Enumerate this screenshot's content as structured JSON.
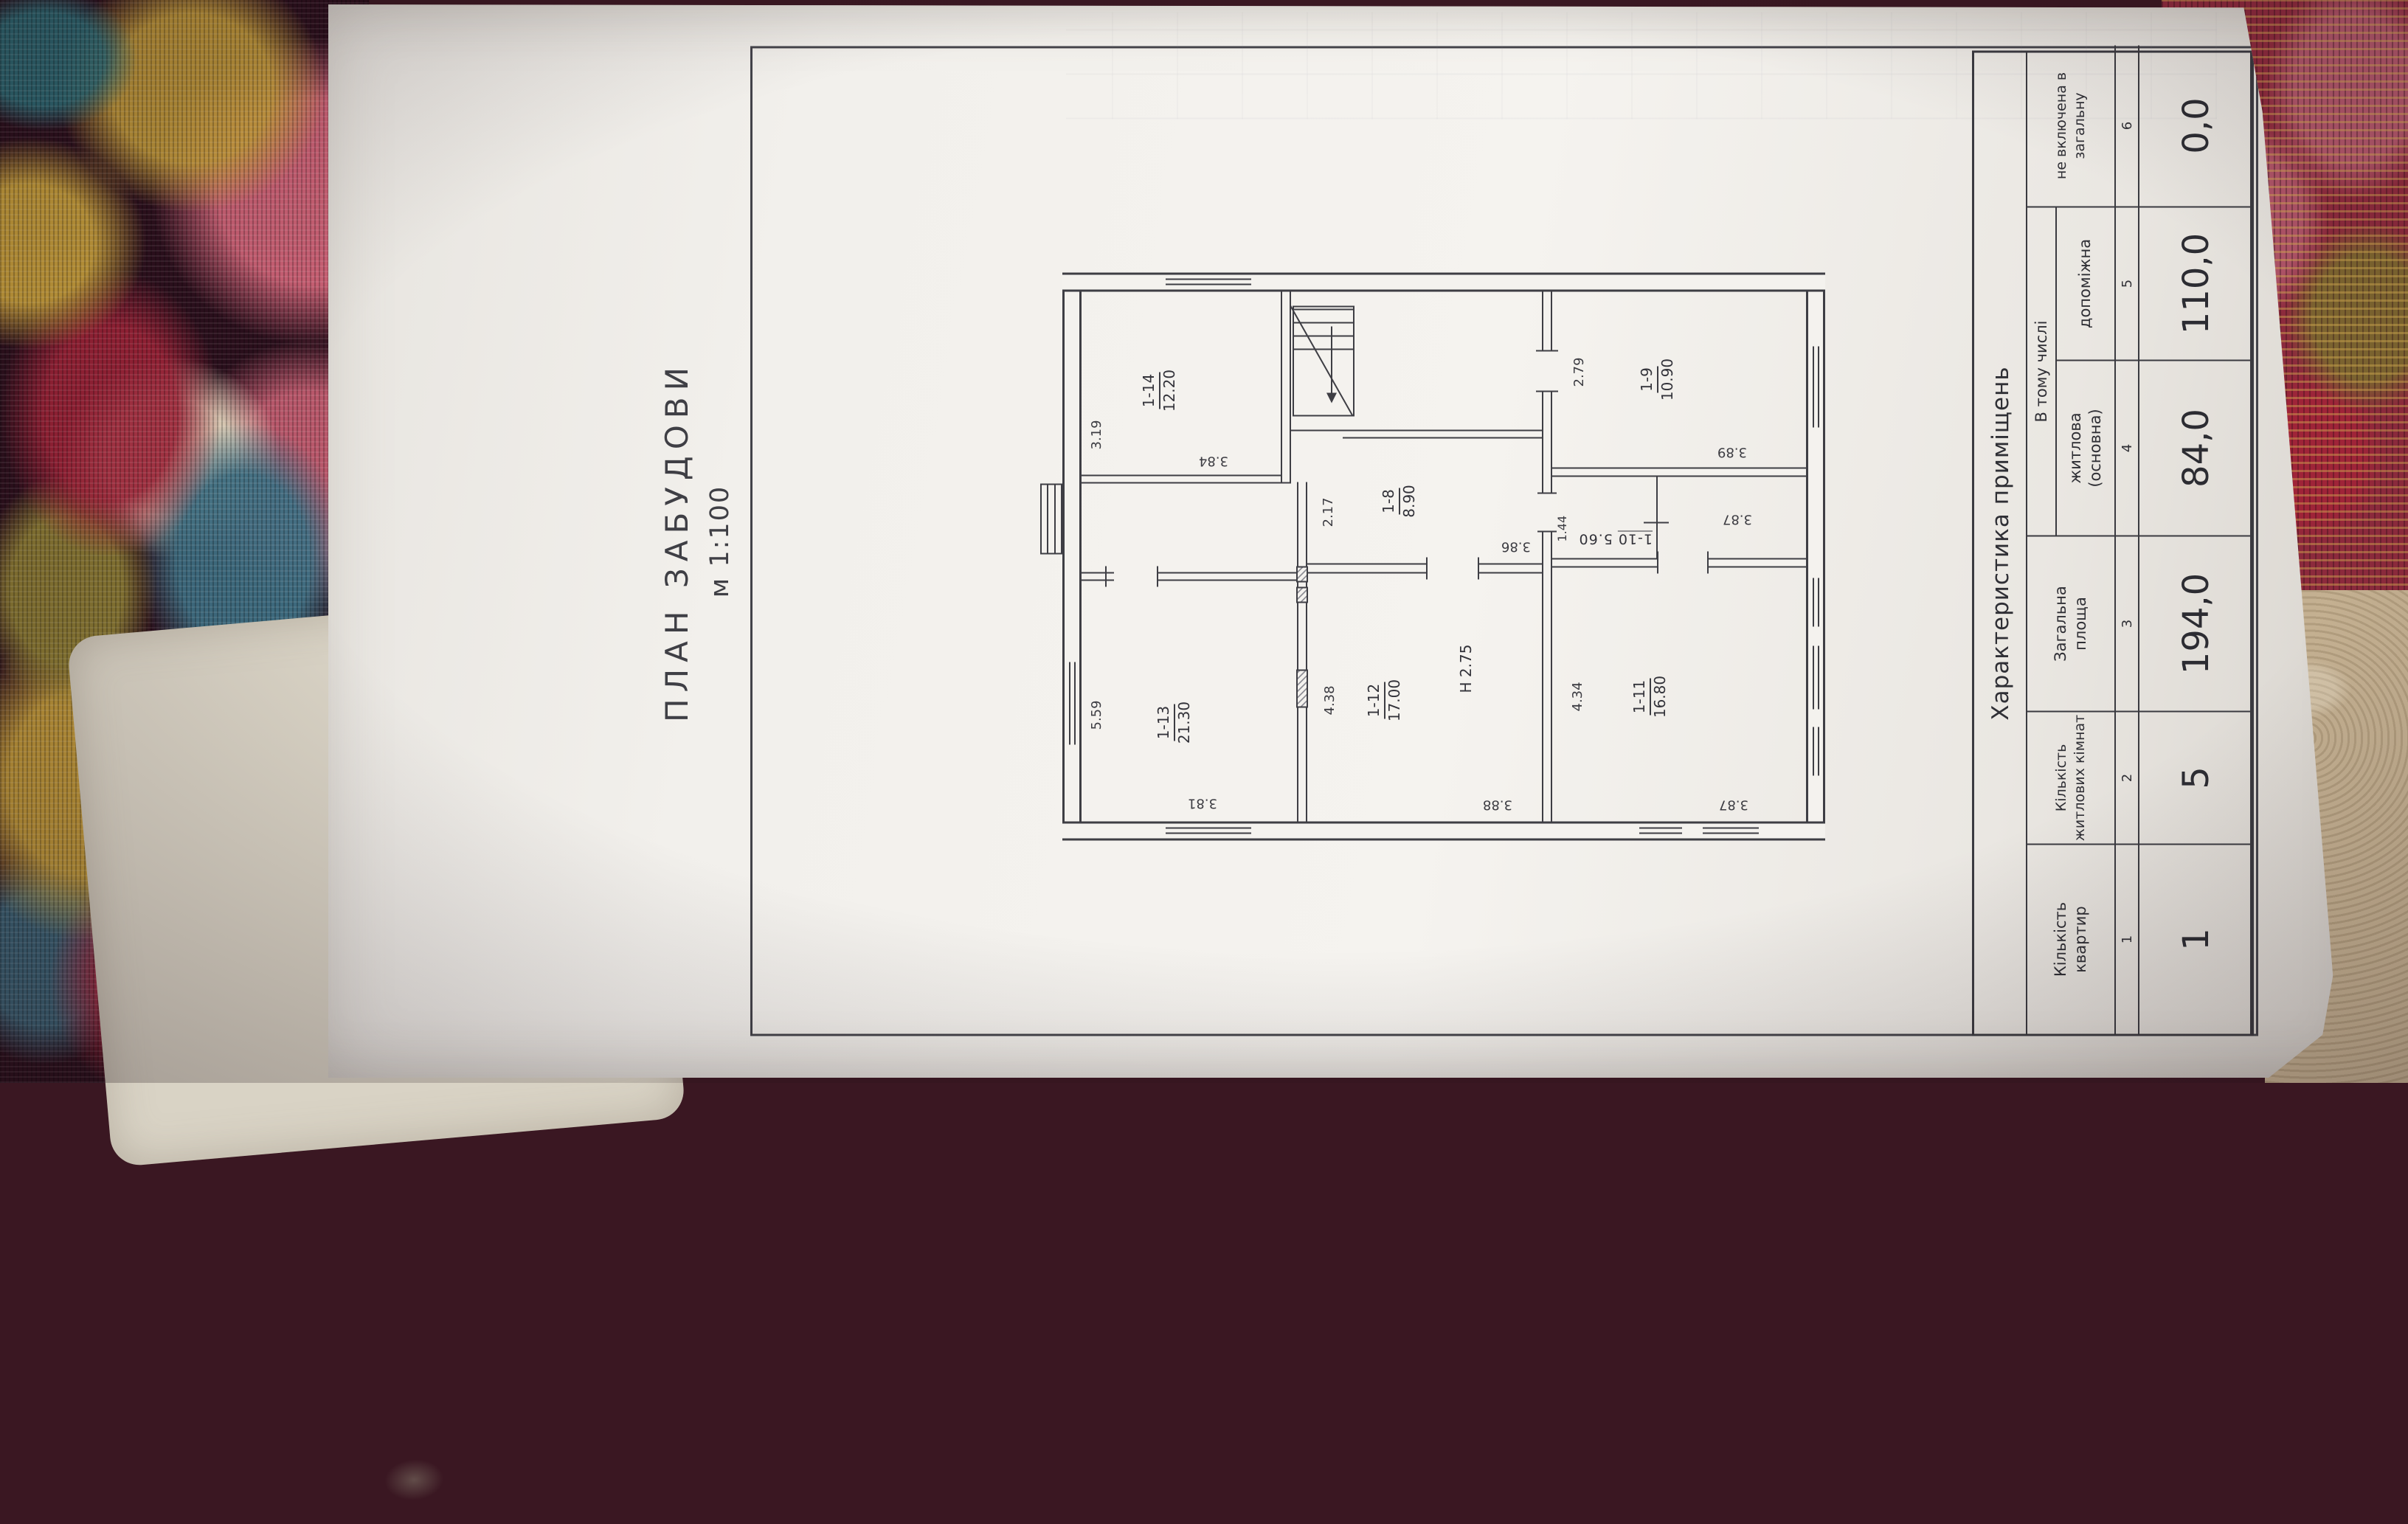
{
  "document": {
    "title": "ПЛАН ЗАБУДОВИ",
    "scale": "м 1:100",
    "plan": {
      "rooms": [
        {
          "id": "1-13",
          "area": "21.30",
          "w": "5.59",
          "d": "3.81"
        },
        {
          "id": "1-14",
          "area": "12.20",
          "w": "3.19",
          "d": "3.84"
        },
        {
          "id": "1-12",
          "area": "17.00",
          "w": "4.38",
          "d": "3.88",
          "height_note": "Н 2.75"
        },
        {
          "id": "1-8",
          "area": "8.90",
          "w": "2.17",
          "d": "3.86"
        },
        {
          "id": "1-11",
          "area": "16.80",
          "w": "4.34",
          "d": "3.87"
        },
        {
          "id": "1-10",
          "area": "5.60",
          "w": "1.44",
          "d": "3.87"
        },
        {
          "id": "1-9",
          "area": "10.90",
          "w": "2.79",
          "d": "3.89"
        }
      ]
    },
    "table": {
      "title": "Характеристика приміщень",
      "group_header": "В тому числі",
      "columns": [
        {
          "lines": [
            "Кількість",
            "квартир"
          ],
          "num": "1",
          "value": "1"
        },
        {
          "lines": [
            "Кількість",
            "житлових кімнат"
          ],
          "num": "2",
          "value": "5"
        },
        {
          "lines": [
            "Загальна",
            "площа"
          ],
          "num": "3",
          "value": "194,0"
        },
        {
          "lines": [
            "житлова",
            "(основна)"
          ],
          "num": "4",
          "value": "84,0"
        },
        {
          "lines": [
            "допоміжна",
            ""
          ],
          "num": "5",
          "value": "110,0"
        },
        {
          "lines": [
            "не включена в",
            "загальну"
          ],
          "num": "6",
          "value": "0,0"
        }
      ]
    },
    "palette": {
      "paper": "#f2f0ec",
      "ink": "#3a3a40",
      "tapestry_maroon": "#2b0f1c",
      "tapestry_gold": "#c9a13b",
      "tapestry_pink": "#d4687a",
      "tapestry_teal": "#3e6f83",
      "felt": "#d9d3c5",
      "blanket": "#c4b091"
    }
  }
}
